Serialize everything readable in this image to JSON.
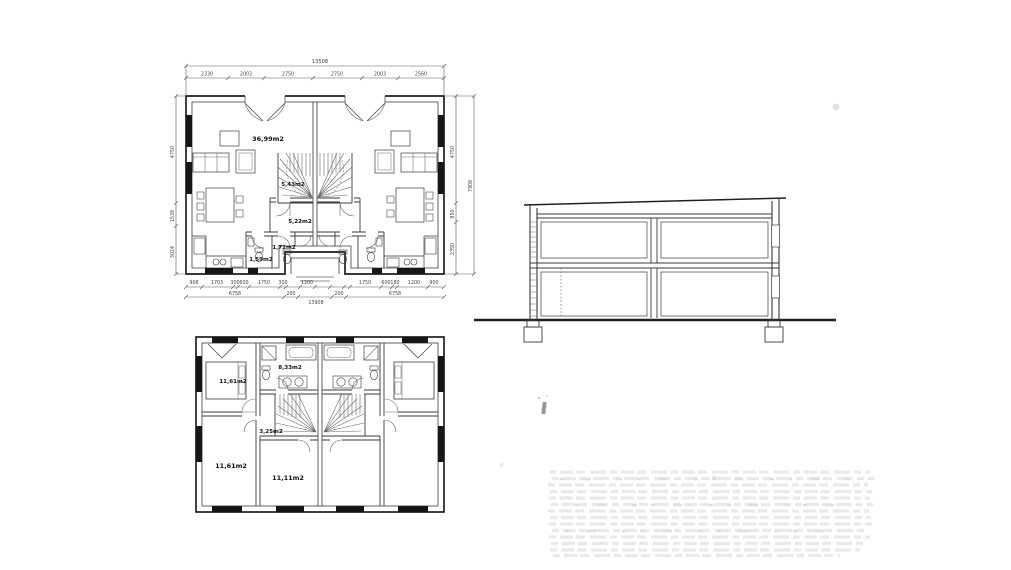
{
  "upper_plan": {
    "labels": {
      "living": "36,99m2",
      "stairs": "5,43m2",
      "hall": "5,22m2",
      "wc": "1,72m2",
      "storage": "1,59m2"
    },
    "dims": {
      "top_total": "13508",
      "top": [
        "2330",
        "2003",
        "2750",
        "2750",
        "2003",
        "2560"
      ],
      "bottom": [
        "908",
        "1703",
        "300",
        "600",
        "1750",
        "300",
        "1200",
        "1750",
        "600",
        "180",
        "1200",
        "900"
      ],
      "bottom2": [
        "6758",
        "200",
        "13908",
        "200",
        "6758"
      ],
      "left": [
        "4750",
        "1538",
        "3024"
      ],
      "right": [
        "4750",
        "850",
        "2350"
      ],
      "right_total": "7908"
    }
  },
  "lower_plan": {
    "labels": {
      "bedroom_top": "11,61m2",
      "bathroom": "8,33m2",
      "hall": "3,25m2",
      "bedroom_bottom": "11,61m2",
      "bedroom_mid": "11,11m2"
    }
  }
}
